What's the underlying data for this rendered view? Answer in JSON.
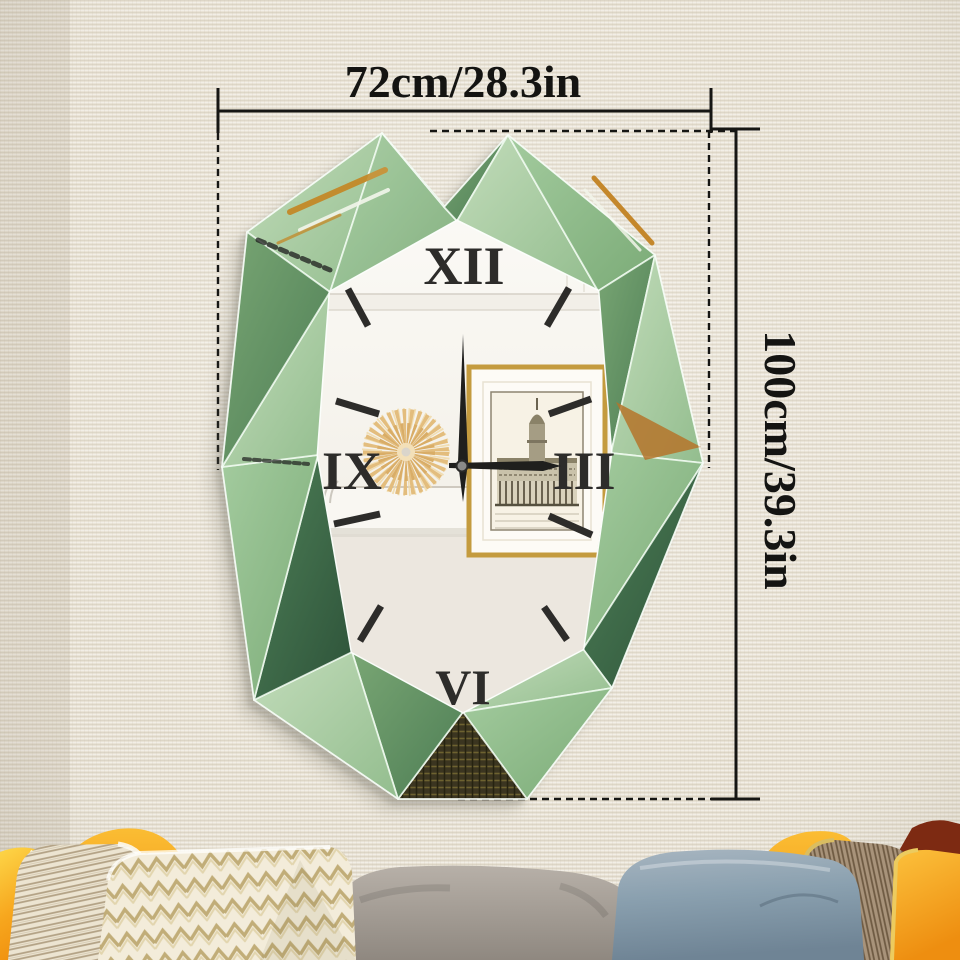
{
  "annotations": {
    "width_label": "72cm/28.3in",
    "height_label": "100cm/39.3in"
  },
  "clock": {
    "numeral_top": "XII",
    "numeral_right": "III",
    "numeral_bottom": "VI",
    "numeral_left": "IX",
    "time_shown": "3:00",
    "hour_markers_count": 8
  },
  "palette": {
    "wall": "#e9e3d6",
    "dimension_line": "#161614",
    "frame_green_light": "#b9d7b2",
    "frame_green_dark": "#3f6d4b",
    "gold_reflection": "#c4872b",
    "clock_face": "#f6f3ec",
    "pillow_orange": "#f59d14",
    "pillow_blue": "#8aa0af",
    "pillow_cream": "#f3ecda",
    "pillow_brown_stripe": "#a8937a",
    "pillow_dark_red": "#7d2a12",
    "sofa_gray": "#a49d95"
  }
}
